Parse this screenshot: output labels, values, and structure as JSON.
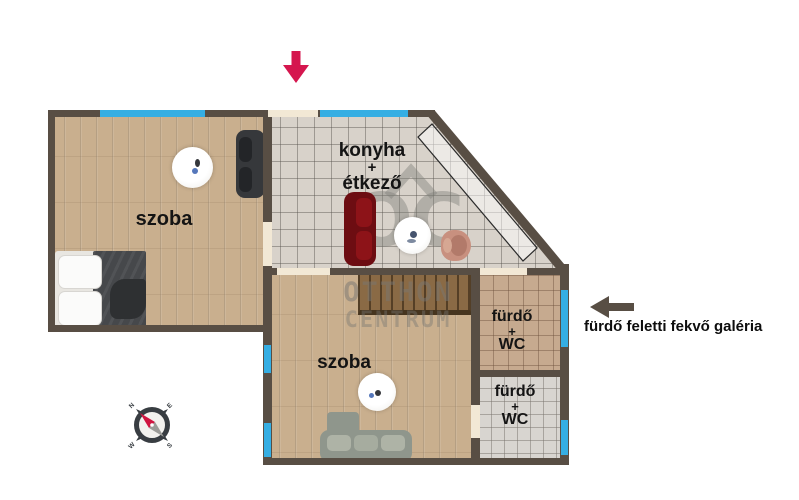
{
  "plan": {
    "rooms": {
      "room_top_left": {
        "label": "szoba"
      },
      "kitchen": {
        "line1": "konyha",
        "line2": "+",
        "line3": "étkező"
      },
      "room_bottom": {
        "label": "szoba"
      },
      "bath_top": {
        "line1": "fürdő",
        "line2": "+",
        "line3": "WC"
      },
      "bath_bottom": {
        "line1": "fürdő",
        "line2": "+",
        "line3": "WC"
      }
    },
    "annotation": {
      "text": "fürdő feletti fekvő galéria"
    },
    "watermark": {
      "logo": "OC",
      "line1": "OTTHON",
      "line2": "CENTRUM"
    },
    "compass": {
      "north": "N",
      "east": "E",
      "south": "S",
      "west": "W"
    }
  },
  "colors": {
    "wall": "#584e44",
    "window": "#35aee3",
    "door": "#f2e8d5",
    "entry_arrow": "#d5164e",
    "annotation_arrow": "#584e44",
    "compass_needle_north": "#cf1440",
    "compass_needle_south": "#9b9b98"
  }
}
